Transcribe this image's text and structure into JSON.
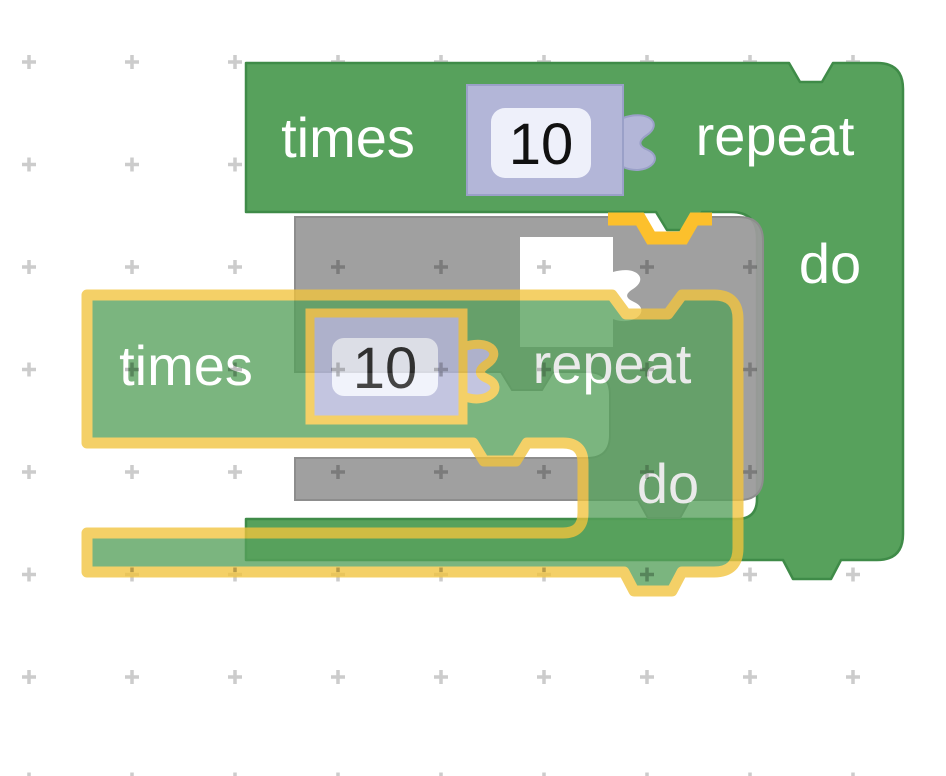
{
  "workspace": {
    "grid_color": "#cccccc",
    "outer_block": {
      "label_times": "times",
      "value": "10",
      "label_repeat": "repeat",
      "label_do": "do",
      "color": "#57a15c"
    },
    "insertion_marker": {
      "color": "#9b9b9b",
      "connection_highlight_color": "#fcc02c"
    },
    "dragged_block": {
      "label_times": "times",
      "value": "10",
      "label_repeat": "repeat",
      "label_do": "do",
      "color": "#57a15c",
      "highlight_color": "#f2c43d"
    },
    "shadow_block_color": "#b3b6d8",
    "field_background_color": "#eef0fa"
  }
}
